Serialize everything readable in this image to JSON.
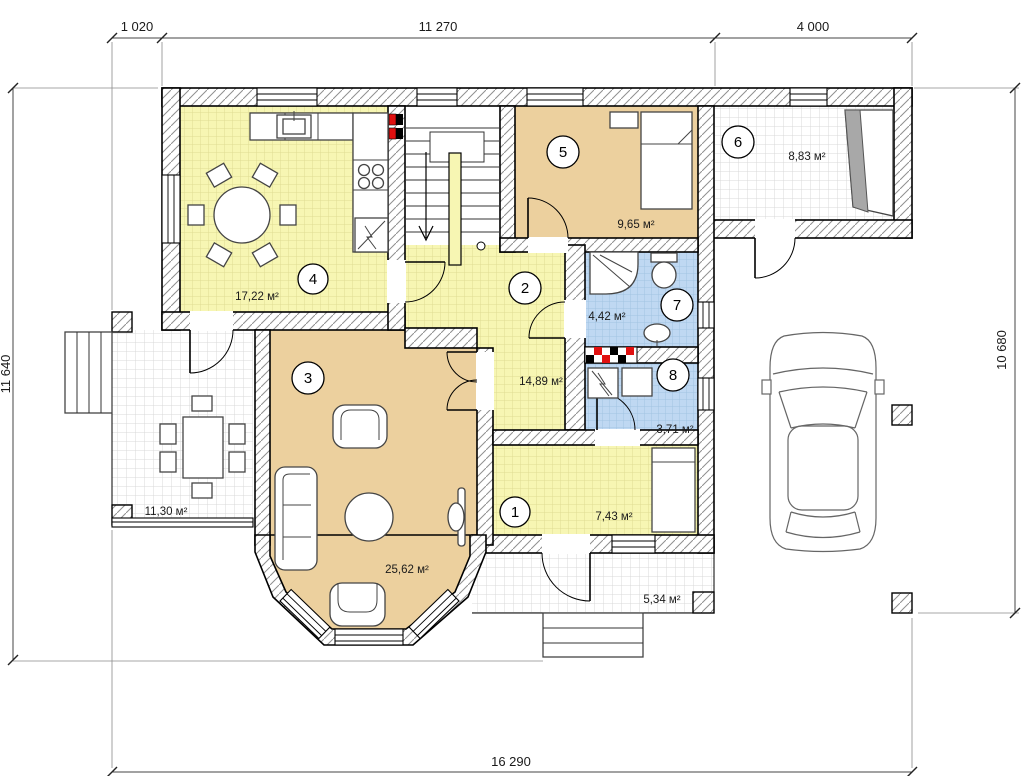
{
  "plan": {
    "dimensions": {
      "top_segment_1": "1 020",
      "top_segment_2": "11 270",
      "top_segment_3": "4 000",
      "left_total": "11 640",
      "right_total": "10 680",
      "bottom_total": "16 290"
    },
    "rooms": [
      {
        "number": "1",
        "area": "7,43 м²"
      },
      {
        "number": "2",
        "area": "14,89 м²"
      },
      {
        "number": "3",
        "area": "25,62 м²"
      },
      {
        "number": "4",
        "area": "17,22 м²"
      },
      {
        "number": "5",
        "area": "9,65 м²"
      },
      {
        "number": "6",
        "area": "8,83 м²"
      },
      {
        "number": "7",
        "area": "4,42 м²"
      },
      {
        "number": "8",
        "area": "3,71 м²"
      }
    ],
    "areas": {
      "terrace": "11,30 м²",
      "porch": "5,34 м²"
    },
    "colors": {
      "floor_yellow": "#f7f6b3",
      "floor_tan": "#ecd09e",
      "floor_blue": "#bfd8f2",
      "tile_white": "#ffffff",
      "vent_red": "#e01010",
      "hatch_line": "#8f8f8f"
    }
  }
}
